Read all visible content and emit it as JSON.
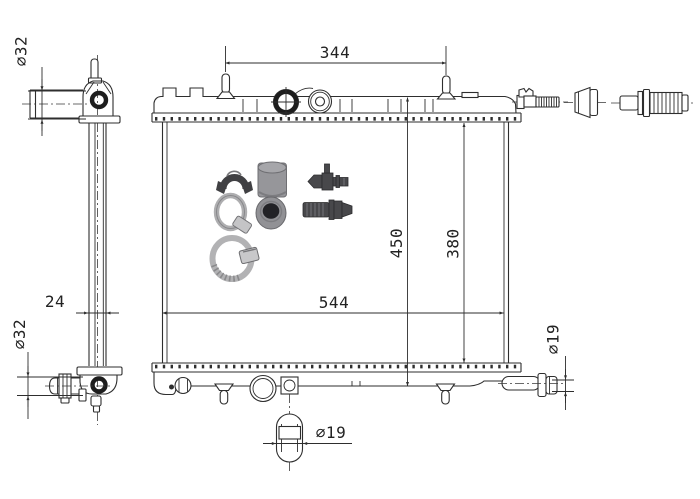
{
  "drawing": {
    "type": "radiator-technical-drawing",
    "views": {
      "side_view": "radiator side profile with inlet and outlet pipes",
      "front_view": "radiator front view with accessory kit",
      "loose_parts": "threaded stud, tapered plug, ribbed hose connector"
    },
    "dims": {
      "d344": "344",
      "d450": "450",
      "d380": "380",
      "d544": "544",
      "d24": "24",
      "d32_top": "⌀32",
      "d32_bottom": "⌀32",
      "d19_drain": "⌀19",
      "d19_outlet": "⌀19"
    },
    "colors": {
      "background": "#ffffff",
      "line": "#2e2e2e",
      "accessory_dark": "#48484b",
      "accessory_gray": "#96969a",
      "clamp_metal": "#b2b2b4",
      "rubber_hole": "#222226"
    }
  }
}
